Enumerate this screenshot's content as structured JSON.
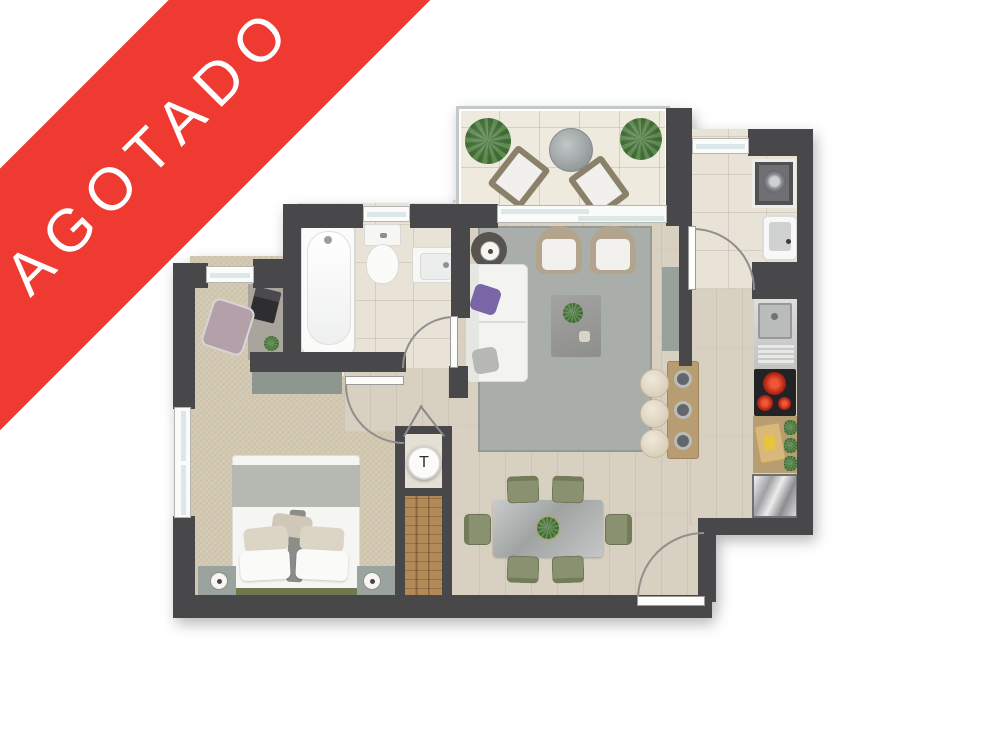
{
  "banner": {
    "label": "AGOTADO",
    "background_color": "#ee3a31",
    "text_color": "#ffffff"
  },
  "labels": {
    "shaft": "T"
  },
  "palette": {
    "wall": "#48484b",
    "wood_floor": "#d8d0c1",
    "carpet": "#d3c9b2",
    "bath_tile": "#e9e3d7",
    "terrace_tile": "#efeade",
    "rug": "#a9aeab",
    "accent_red": "#ee3a31",
    "olive_chair": "#8a9170",
    "counter_wood": "#b89d72"
  },
  "rooms": {
    "terrace": [
      "plant",
      "round-table",
      "lounge-chair",
      "lounge-chair"
    ],
    "living": [
      "sofa",
      "side-table-lamp",
      "armchair",
      "armchair",
      "coffee-table",
      "rug",
      "island-cabinet",
      "breakfast-bar",
      "stools"
    ],
    "dining": [
      "dining-table",
      "six-olive-chairs",
      "centerpiece"
    ],
    "kitchen": [
      "sink",
      "cooktop",
      "prep-counter",
      "fridge"
    ],
    "laundry": [
      "washing-machine",
      "laundry-tub"
    ],
    "bathroom": [
      "bathtub",
      "toilet",
      "vanity-sink"
    ],
    "bedroom": [
      "desk",
      "desk-chair",
      "dresser",
      "double-bed",
      "nightstand",
      "nightstand",
      "closet",
      "duct-shaft"
    ]
  }
}
